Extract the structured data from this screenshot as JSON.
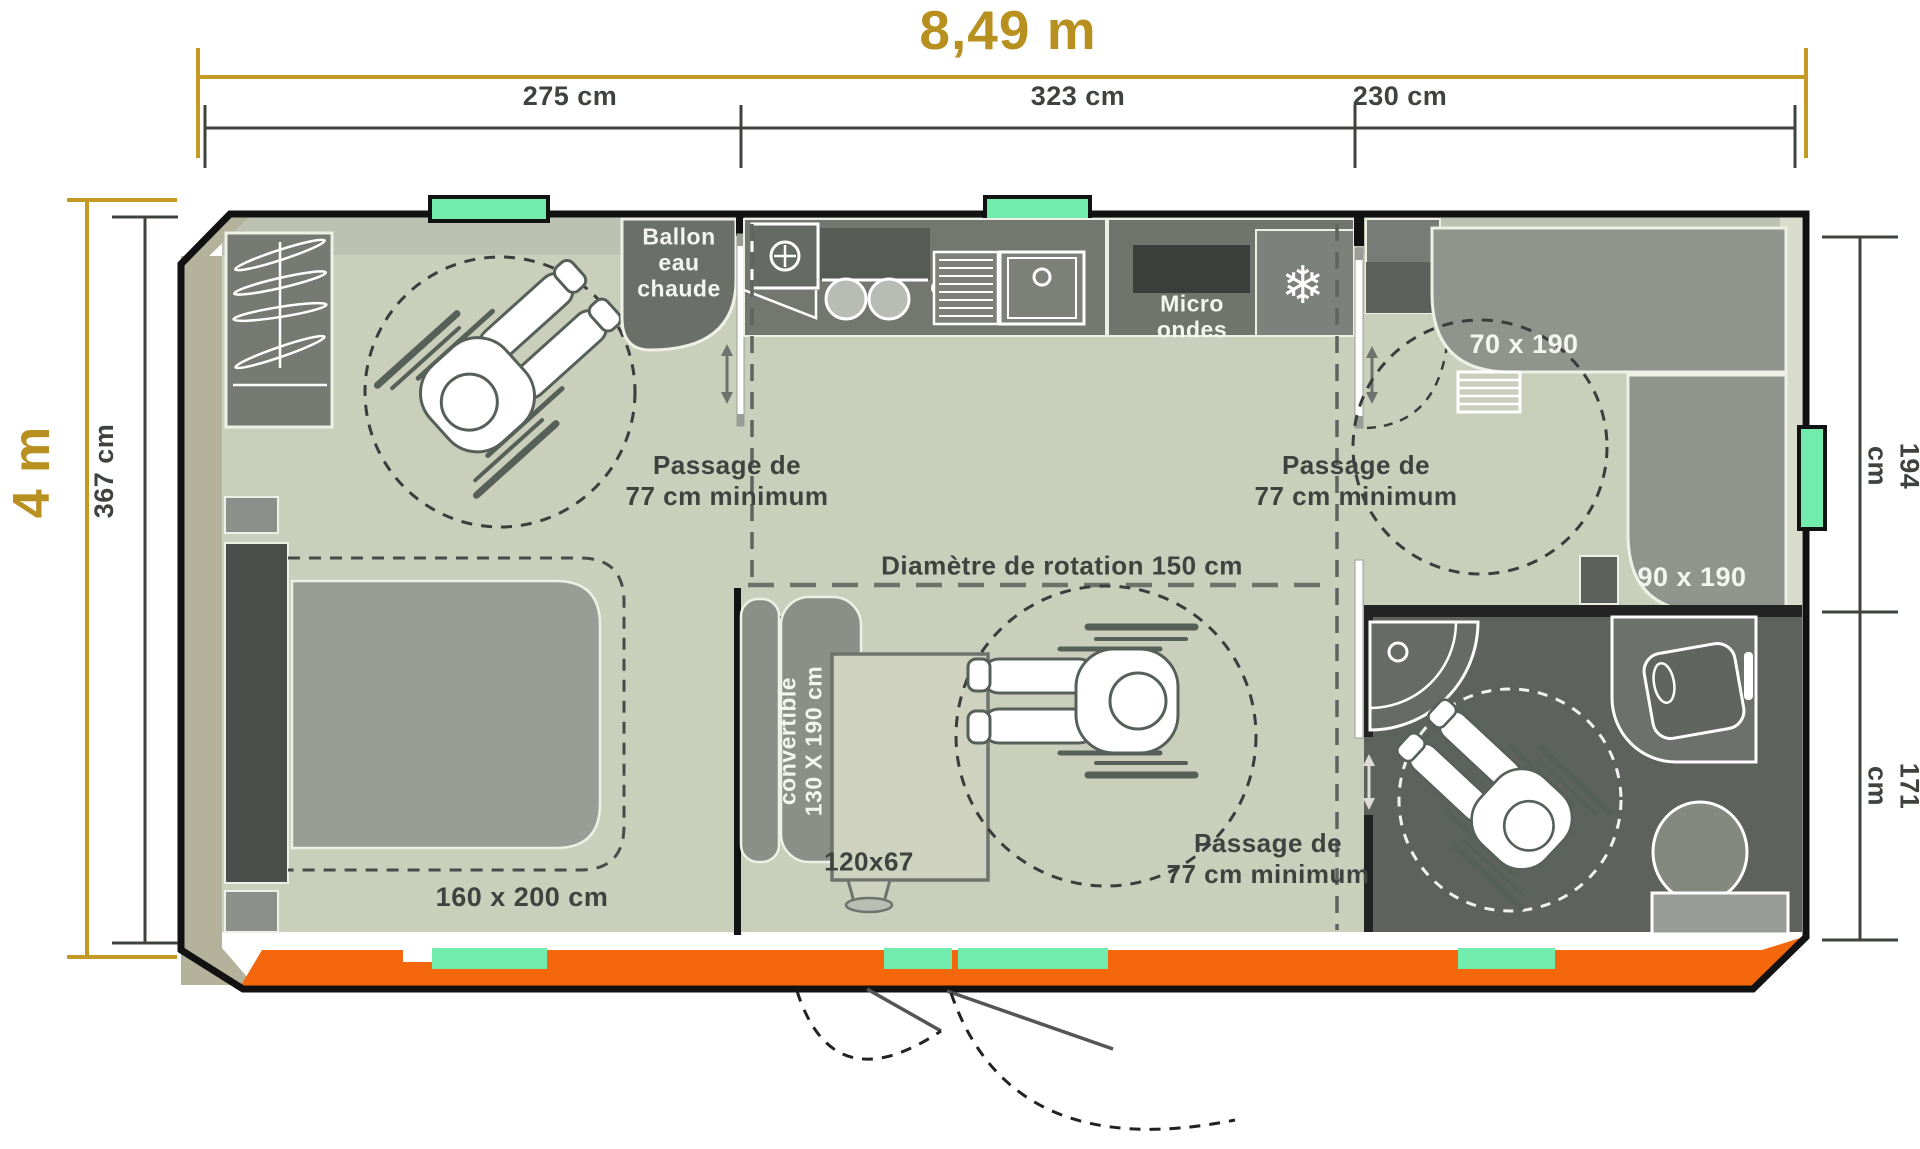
{
  "title": "Plan mobil-home accessible PMR",
  "dimensions": {
    "total_width": "8,49 m",
    "section_left": "275 cm",
    "section_middle": "323 cm",
    "section_right": "230 cm",
    "total_height": "4 m",
    "interior_height": "367 cm",
    "right_top": "194 cm",
    "right_bottom": "171 cm"
  },
  "labels": {
    "water_heater": "Ballon\neau\nchaude",
    "microwave": "Micro\nondes",
    "passage": "Passage de\n77 cm minimum",
    "rotation_diameter": "Diamètre de rotation 150 cm",
    "master_bed": "160 x 200 cm",
    "bunk_bed_top": "70 x 190",
    "bunk_bed_side": "90 x 190",
    "sofa": "convertible\n130 X 190 cm",
    "table": "120x67"
  },
  "icons": {
    "freezer_icon": "❄"
  },
  "colors": {
    "accent_gold": "#b8901f",
    "deck_orange": "#f4670d",
    "window_mint": "#72ecac",
    "floor_sage": "#cacfbc",
    "wall_black": "#121212",
    "wall_tan": "#b5b29b",
    "furniture_gray": "#9a9d96",
    "counter_gray": "#73776f",
    "bathroom_gray": "#5e625d",
    "text_dark": "#3f433f",
    "label_white": "#f4f5f0"
  }
}
